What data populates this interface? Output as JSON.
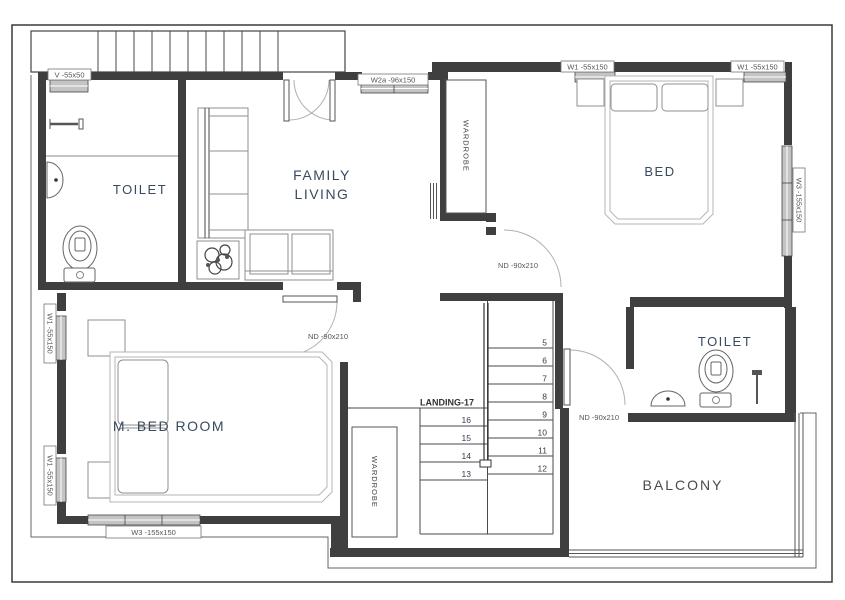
{
  "rooms": {
    "toilet1": "TOILET",
    "family_living_lines": [
      "FAMILY",
      "LIVING"
    ],
    "bed": "BED",
    "m_bed_room": "M. BED ROOM",
    "toilet2": "TOILET",
    "balcony": "BALCONY"
  },
  "wardrobes": {
    "top": "WARDROBE",
    "bottom": "WARDROBE"
  },
  "windows": {
    "v": "V -55x50",
    "w2a": "W2a -96x150",
    "w1_top_left": "W1 -55x150",
    "w1_top_right": "W1 -55x150",
    "w1_side_upper": "W1 -55x150",
    "w1_side_lower": "W1 -55x150",
    "w3_right": "W3 -155x150",
    "w3_bottom": "W3 -155x150"
  },
  "doors": {
    "master_bedroom": "ND -90x210",
    "bedroom": "ND -90x210",
    "toilet": "ND -90x210"
  },
  "stairs": {
    "landing_label": "LANDING-17",
    "right_flight": [
      "5",
      "6",
      "7",
      "8",
      "9",
      "10",
      "11",
      "12"
    ],
    "left_flight": [
      "16",
      "15",
      "14",
      "13"
    ]
  },
  "colors": {
    "wall": "#3f3f3f",
    "room_text": "#3a4a5e",
    "annotation_text": "#555555",
    "furniture": "#8f8f8f"
  }
}
